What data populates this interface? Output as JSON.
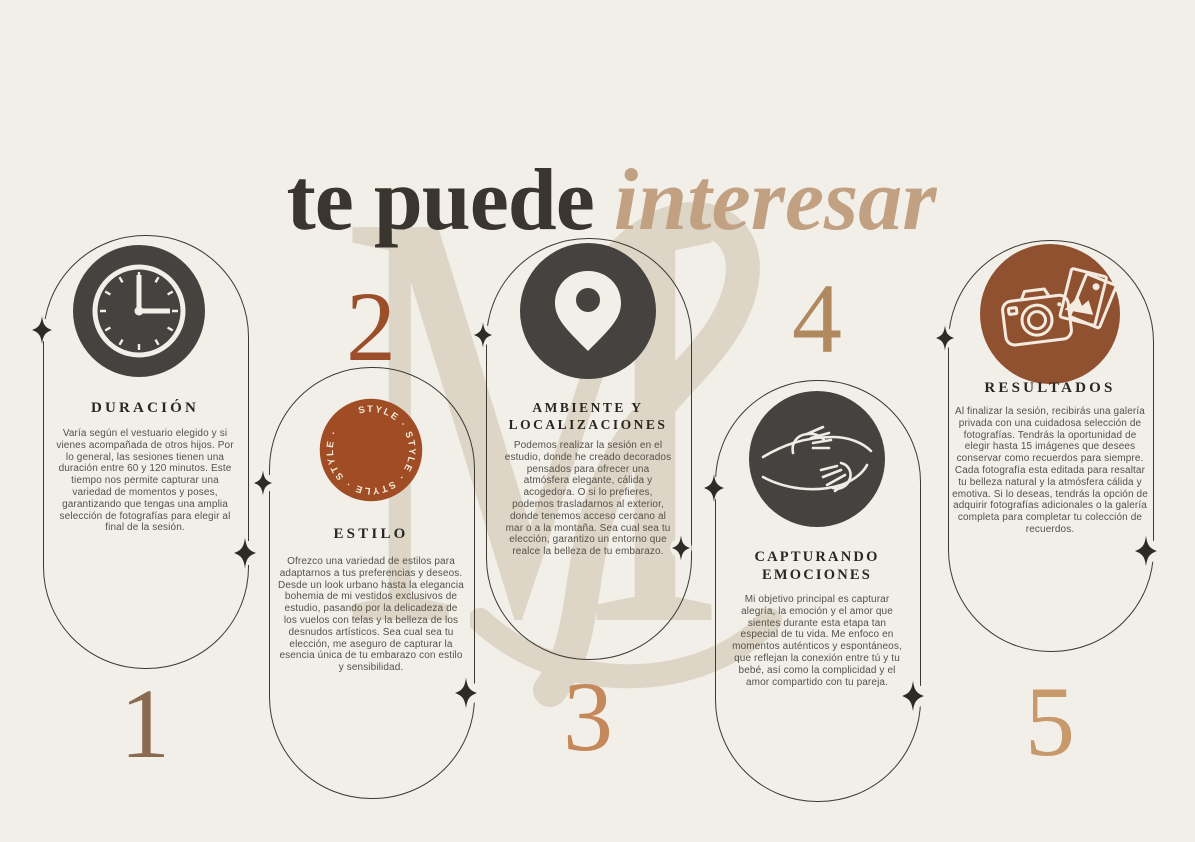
{
  "title": {
    "prefix": "te puede",
    "accent": "interesar"
  },
  "watermark": {
    "letter": "M"
  },
  "colors": {
    "background": "#f2efe9",
    "title_dark": "#3a362f",
    "title_accent": "#c2a183",
    "pill_outline": "#3c3933",
    "dark_circle": "#454240",
    "rust_badge": "#a04c24",
    "rust_camera": "#8f5130",
    "heading": "#2a2621",
    "body": "#55514b",
    "sparkle": "#2e2b27",
    "watermark": "#ddd5c6"
  },
  "sections": [
    {
      "number": "1",
      "number_color": "#8a6a50",
      "heading": "DURACIÓN",
      "icon": "clock-icon",
      "body": "Varía según el vestuario elegido y si vienes acompañada de otros hijos. Por lo general, las sesiones tienen una duración entre 60 y 120 minutos. Este tiempo nos permite capturar una variedad de momentos y poses, garantizando que tengas una amplia selección de fotografías para elegir al final de la sesión."
    },
    {
      "number": "2",
      "number_color": "#9c4e2b",
      "heading": "ESTILO",
      "icon": "style-badge",
      "badge_text": "STYLE · STYLE · STYLE · STYLE ·",
      "body": "Ofrezco una variedad de estilos para adaptarnos a tus preferencias y deseos. Desde un look urbano hasta la elegancia bohemia de mi vestidos exclusivos de estudio, pasando por la delicadeza de los vuelos con telas y la belleza de los desnudos artísticos. Sea cual sea tu elección, me aseguro de capturar la esencia única de tu embarazo con estilo y sensibilidad."
    },
    {
      "number": "3",
      "number_color": "#c5885a",
      "heading": "AMBIENTE Y LOCALIZACIONES",
      "icon": "location-pin-icon",
      "body": "Podemos realizar la sesión en el estudio, donde he creado decorados pensados para ofrecer una atmósfera elegante, cálida y acogedora. O si lo prefieres, podemos trasladarnos al exterior, donde tenemos acceso cercano al mar o a la montaña. Sea cual sea tu elección, garantizo un entorno que realce la belleza de tu embarazo."
    },
    {
      "number": "4",
      "number_color": "#b1895e",
      "heading": "CAPTURANDO EMOCIONES",
      "icon": "hugging-arms-icon",
      "body": "Mi objetivo principal es capturar alegría, la emoción y el amor que sientes durante esta etapa tan especial de tu vida. Me enfoco en momentos auténticos y espontáneos, que reflejan la conexión entre tú y tu bebé, así como la complicidad y el amor compartido con tu pareja."
    },
    {
      "number": "5",
      "number_color": "#c8996b",
      "heading": "RESULTADOS",
      "icon": "camera-photos-icon",
      "body": "Al finalizar la sesión, recibirás una galería privada con una cuidadosa selección de fotografías. Tendrás la oportunidad de elegir hasta 15 imágenes que desees conservar como recuerdos para siempre. Cada fotografía esta editada para resaltar tu belleza natural y la atmósfera cálida y emotiva. Si lo deseas, tendrás la opción de adquirir fotografías adicionales o la galería completa para completar tu colección de recuerdos."
    }
  ]
}
